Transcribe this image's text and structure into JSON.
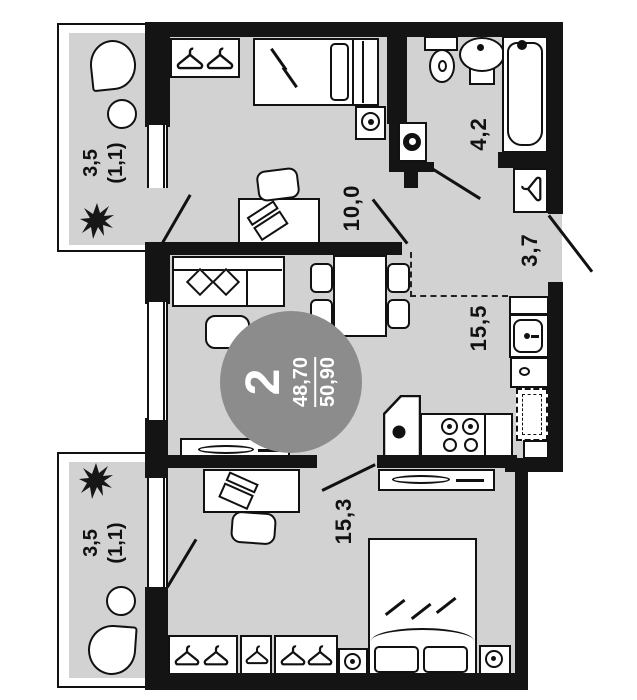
{
  "plan": {
    "title": "2-room apartment floor plan",
    "badge": {
      "rooms_count": "2",
      "area_living": "48,70",
      "area_total": "50,90"
    },
    "labels": {
      "bedroom_top": "10,0",
      "bathroom": "4,2",
      "hallway": "3,7",
      "living_kitchen": "15,5",
      "bedroom_bottom": "15,3",
      "balcony_top": {
        "area": "3,5",
        "reduced": "(1,1)"
      },
      "balcony_bottom": {
        "area": "3,5",
        "reduced": "(1,1)"
      }
    },
    "colors": {
      "wall": "#141414",
      "floor": "#d2d2d2",
      "badge": "#8c8c8c",
      "stroke": "#111111",
      "background": "#ffffff"
    },
    "icons": [
      "hanger-icon",
      "plant-icon",
      "bed",
      "pillow",
      "sofa",
      "coffee-table",
      "dining-table",
      "chair",
      "desk",
      "laptop-icon",
      "wardrobe",
      "toilet",
      "washbasin",
      "bathtub",
      "washing-machine-icon",
      "kitchen-sink",
      "corner-sink",
      "stove-burners",
      "fridge",
      "tv-stand",
      "sideboard",
      "speaker",
      "nightstand-lamp",
      "armchair",
      "round-table",
      "door-swing",
      "window",
      "open-plan-dashed-boundary"
    ]
  }
}
